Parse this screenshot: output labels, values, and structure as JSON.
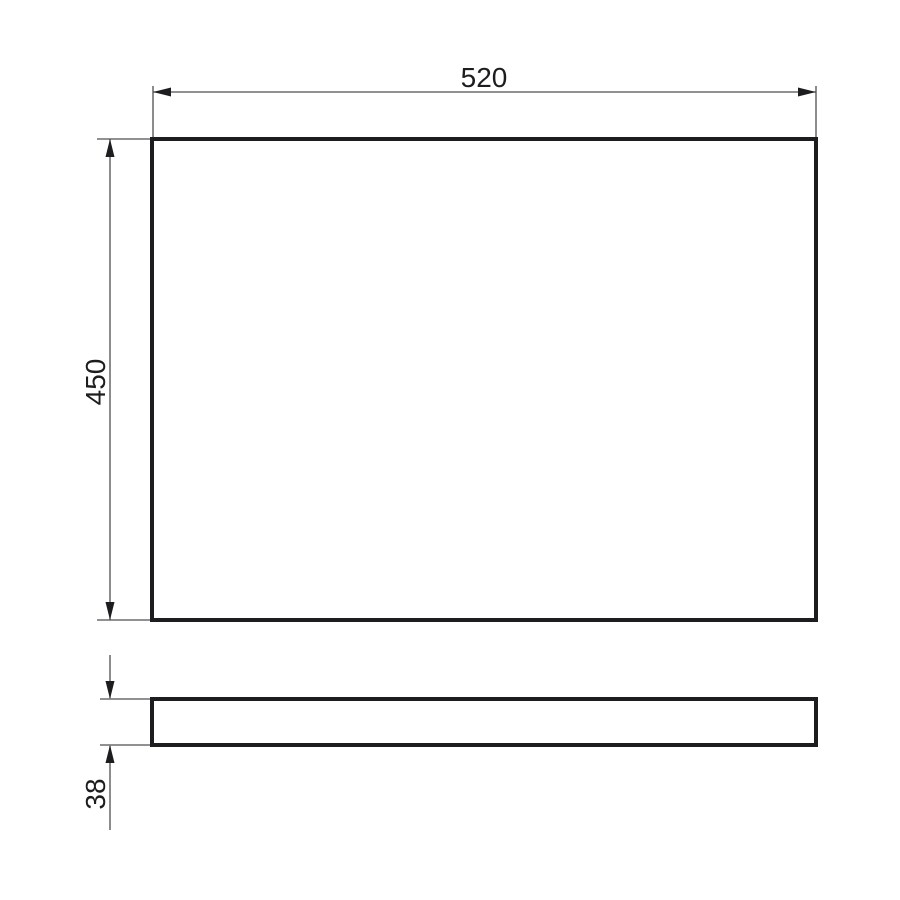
{
  "drawing": {
    "dimensions": {
      "width": {
        "label": "520"
      },
      "height": {
        "label": "450"
      },
      "thickness": {
        "label": "38"
      }
    },
    "colors": {
      "background": "#ffffff",
      "object_line": "#1d1d1f",
      "dimension_line": "#4f4f4f",
      "arrow": "#1d1d1f",
      "text": "#1d1d1f"
    }
  }
}
